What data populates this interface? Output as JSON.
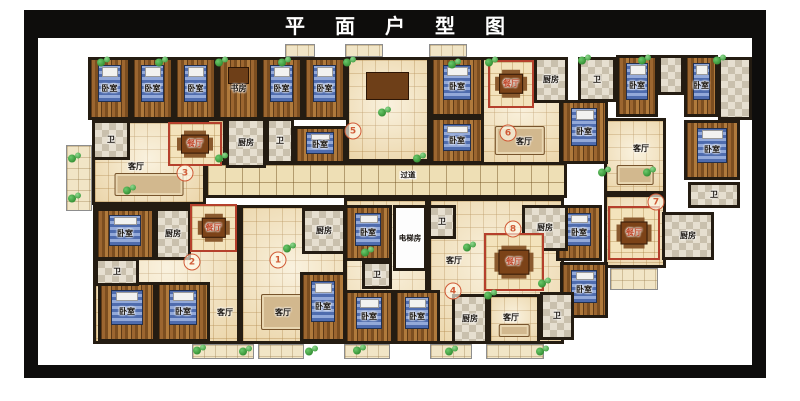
{
  "title": "平面户型图",
  "colors": {
    "frame": "#0e0d0c",
    "wall": "#241c12",
    "wood_floor": "#9c6630",
    "tile_floor": "#f5e7c4",
    "dining_border": "#b5402c",
    "unit_number": "#d05a36",
    "plant_green": "#2f8f2f"
  },
  "room_label_legend": {
    "bedroom": "卧室",
    "study": "书房",
    "living_room": "客厅",
    "dining_room": "餐厅",
    "kitchen": "厨房",
    "bathroom": "卫",
    "corridor": "过道",
    "elevator_room": "电梯房"
  },
  "plan": {
    "units": [
      {
        "n": "1",
        "x": 278,
        "y": 260
      },
      {
        "n": "2",
        "x": 192,
        "y": 262
      },
      {
        "n": "3",
        "x": 185,
        "y": 173
      },
      {
        "n": "4",
        "x": 453,
        "y": 291
      },
      {
        "n": "5",
        "x": 353,
        "y": 131
      },
      {
        "n": "6",
        "x": 508,
        "y": 133
      },
      {
        "n": "7",
        "x": 656,
        "y": 202
      },
      {
        "n": "8",
        "x": 513,
        "y": 229
      }
    ],
    "rooms": [
      {
        "n": "balcony",
        "x": 66,
        "y": 145,
        "w": 26,
        "h": 66,
        "f": "balc"
      },
      {
        "n": "balcony",
        "x": 285,
        "y": 44,
        "w": 30,
        "h": 13,
        "f": "balc"
      },
      {
        "n": "balcony",
        "x": 345,
        "y": 44,
        "w": 38,
        "h": 13,
        "f": "balc"
      },
      {
        "n": "balcony",
        "x": 429,
        "y": 44,
        "w": 38,
        "h": 13,
        "f": "balc"
      },
      {
        "n": "balcony",
        "x": 192,
        "y": 344,
        "w": 62,
        "h": 15,
        "f": "balc"
      },
      {
        "n": "balcony",
        "x": 258,
        "y": 344,
        "w": 46,
        "h": 15,
        "f": "balc"
      },
      {
        "n": "balcony",
        "x": 344,
        "y": 344,
        "w": 46,
        "h": 15,
        "f": "balc"
      },
      {
        "n": "balcony",
        "x": 430,
        "y": 344,
        "w": 42,
        "h": 15,
        "f": "balc"
      },
      {
        "n": "balcony",
        "x": 486,
        "y": 344,
        "w": 58,
        "h": 15,
        "f": "balc"
      },
      {
        "n": "balcony",
        "x": 610,
        "y": 268,
        "w": 48,
        "h": 22,
        "f": "balc"
      },
      {
        "n": "living-room-unit3",
        "l": "客厅",
        "x": 92,
        "y": 120,
        "w": 114,
        "h": 85,
        "f": "tile",
        "furn": "sofa",
        "lx": 133,
        "ly": 164
      },
      {
        "n": "hall-unit3",
        "x": 206,
        "y": 118,
        "w": 20,
        "h": 46,
        "f": "tile"
      },
      {
        "n": "hall-unit5",
        "x": 346,
        "y": 57,
        "w": 84,
        "h": 105,
        "f": "tile",
        "furn": "desk"
      },
      {
        "n": "living-room-unit6",
        "l": "客厅",
        "x": 478,
        "y": 57,
        "w": 84,
        "h": 109,
        "f": "tile",
        "furn": "sofa",
        "lx": 521,
        "ly": 139
      },
      {
        "n": "living-room-unit7",
        "l": "客厅",
        "x": 604,
        "y": 118,
        "w": 62,
        "h": 76,
        "f": "tile",
        "furn": "sofa",
        "lx": 638,
        "ly": 146
      },
      {
        "n": "dining-zone-unit7",
        "x": 604,
        "y": 194,
        "w": 62,
        "h": 74,
        "f": "tile"
      },
      {
        "n": "living-room-unit2",
        "l": "客厅",
        "x": 93,
        "y": 205,
        "w": 147,
        "h": 139,
        "f": "tile",
        "lx": 222,
        "ly": 310
      },
      {
        "n": "living-room-unit1",
        "l": "客厅",
        "x": 240,
        "y": 205,
        "w": 106,
        "h": 139,
        "f": "tile",
        "furn": "sofa",
        "lx": 280,
        "ly": 310
      },
      {
        "n": "hall-unit4",
        "x": 344,
        "y": 198,
        "w": 84,
        "h": 146,
        "f": "tile"
      },
      {
        "n": "living-room-unit8",
        "l": "客厅",
        "x": 428,
        "y": 198,
        "w": 136,
        "h": 146,
        "f": "tile",
        "lx": 451,
        "ly": 258
      },
      {
        "n": "living-room-unit4",
        "l": "客厅",
        "x": 488,
        "y": 294,
        "w": 52,
        "h": 50,
        "f": "tile",
        "furn": "sofa",
        "lx": 508,
        "ly": 315
      },
      {
        "n": "corridor",
        "l": "过道",
        "x": 205,
        "y": 162,
        "w": 362,
        "h": 36,
        "f": "corr",
        "lx": 405,
        "ly": 172
      },
      {
        "n": "bedroom",
        "l": "卧室",
        "x": 88,
        "y": 57,
        "w": 43,
        "h": 63,
        "f": "wood",
        "furn": "bed"
      },
      {
        "n": "bedroom",
        "l": "卧室",
        "x": 131,
        "y": 57,
        "w": 43,
        "h": 63,
        "f": "wood",
        "furn": "bed"
      },
      {
        "n": "bedroom",
        "l": "卧室",
        "x": 174,
        "y": 57,
        "w": 43,
        "h": 63,
        "f": "wood",
        "furn": "bed"
      },
      {
        "n": "study",
        "l": "书房",
        "x": 217,
        "y": 57,
        "w": 43,
        "h": 63,
        "f": "wood",
        "furn": "desk"
      },
      {
        "n": "bedroom",
        "l": "卧室",
        "x": 260,
        "y": 57,
        "w": 43,
        "h": 63,
        "f": "wood",
        "furn": "bed"
      },
      {
        "n": "bedroom",
        "l": "卧室",
        "x": 303,
        "y": 57,
        "w": 43,
        "h": 63,
        "f": "wood",
        "furn": "bed"
      },
      {
        "n": "bedroom",
        "l": "卧室",
        "x": 294,
        "y": 126,
        "w": 52,
        "h": 38,
        "f": "wood",
        "furn": "bed"
      },
      {
        "n": "bedroom",
        "l": "卧室",
        "x": 430,
        "y": 57,
        "w": 54,
        "h": 60,
        "f": "wood",
        "furn": "bed"
      },
      {
        "n": "bedroom",
        "l": "卧室",
        "x": 430,
        "y": 117,
        "w": 54,
        "h": 47,
        "f": "wood",
        "furn": "bed"
      },
      {
        "n": "bedroom",
        "l": "卧室",
        "x": 560,
        "y": 100,
        "w": 48,
        "h": 64,
        "f": "wood",
        "furn": "bed"
      },
      {
        "n": "bedroom",
        "l": "卧室",
        "x": 616,
        "y": 55,
        "w": 42,
        "h": 62,
        "f": "wood",
        "furn": "bed"
      },
      {
        "n": "bedroom",
        "l": "卧室",
        "x": 684,
        "y": 55,
        "w": 34,
        "h": 62,
        "f": "wood",
        "furn": "bed"
      },
      {
        "n": "bedroom",
        "l": "卧室",
        "x": 684,
        "y": 120,
        "w": 56,
        "h": 60,
        "f": "wood",
        "furn": "bed"
      },
      {
        "n": "bedroom",
        "l": "卧室",
        "x": 95,
        "y": 208,
        "w": 60,
        "h": 52,
        "f": "wood",
        "furn": "bed"
      },
      {
        "n": "bedroom",
        "l": "卧室",
        "x": 98,
        "y": 282,
        "w": 58,
        "h": 60,
        "f": "wood",
        "furn": "bed"
      },
      {
        "n": "bedroom",
        "l": "卧室",
        "x": 156,
        "y": 282,
        "w": 54,
        "h": 60,
        "f": "wood",
        "furn": "bed"
      },
      {
        "n": "bedroom",
        "l": "卧室",
        "x": 300,
        "y": 272,
        "w": 46,
        "h": 70,
        "f": "wood",
        "furn": "bed"
      },
      {
        "n": "bedroom",
        "l": "卧室",
        "x": 344,
        "y": 205,
        "w": 48,
        "h": 56,
        "f": "wood",
        "furn": "bed"
      },
      {
        "n": "bedroom",
        "l": "卧室",
        "x": 344,
        "y": 290,
        "w": 50,
        "h": 54,
        "f": "wood",
        "furn": "bed"
      },
      {
        "n": "bedroom",
        "l": "卧室",
        "x": 394,
        "y": 290,
        "w": 46,
        "h": 54,
        "f": "wood",
        "furn": "bed"
      },
      {
        "n": "bedroom",
        "l": "卧室",
        "x": 556,
        "y": 205,
        "w": 46,
        "h": 56,
        "f": "wood",
        "furn": "bed"
      },
      {
        "n": "bedroom",
        "l": "卧室",
        "x": 560,
        "y": 262,
        "w": 48,
        "h": 56,
        "f": "wood",
        "furn": "bed"
      },
      {
        "n": "bathroom",
        "l": "卫",
        "x": 92,
        "y": 120,
        "w": 38,
        "h": 40,
        "f": "chk"
      },
      {
        "n": "kitchen",
        "l": "厨房",
        "x": 226,
        "y": 118,
        "w": 40,
        "h": 50,
        "f": "chk"
      },
      {
        "n": "bathroom",
        "l": "卫",
        "x": 266,
        "y": 118,
        "w": 28,
        "h": 46,
        "f": "chk"
      },
      {
        "n": "kitchen",
        "l": "厨房",
        "x": 534,
        "y": 57,
        "w": 34,
        "h": 46,
        "f": "chk"
      },
      {
        "n": "bathroom",
        "l": "卫",
        "x": 578,
        "y": 57,
        "w": 38,
        "h": 45,
        "f": "chk"
      },
      {
        "n": "closet",
        "x": 658,
        "y": 55,
        "w": 26,
        "h": 40,
        "f": "chk"
      },
      {
        "n": "bathroom",
        "x": 718,
        "y": 57,
        "w": 34,
        "h": 63,
        "f": "chk"
      },
      {
        "n": "bathroom",
        "l": "卫",
        "x": 688,
        "y": 182,
        "w": 52,
        "h": 26,
        "f": "chk"
      },
      {
        "n": "kitchen",
        "l": "厨房",
        "x": 662,
        "y": 212,
        "w": 52,
        "h": 48,
        "f": "chk"
      },
      {
        "n": "kitchen",
        "l": "厨房",
        "x": 155,
        "y": 208,
        "w": 36,
        "h": 52,
        "f": "chk"
      },
      {
        "n": "bathroom",
        "l": "卫",
        "x": 95,
        "y": 258,
        "w": 44,
        "h": 28,
        "f": "chk"
      },
      {
        "n": "kitchen",
        "l": "厨房",
        "x": 302,
        "y": 208,
        "w": 44,
        "h": 46,
        "f": "chk"
      },
      {
        "n": "bathroom",
        "l": "卫",
        "x": 362,
        "y": 261,
        "w": 30,
        "h": 28,
        "f": "chk"
      },
      {
        "n": "bathroom",
        "l": "卫",
        "x": 428,
        "y": 205,
        "w": 28,
        "h": 34,
        "f": "chk"
      },
      {
        "n": "kitchen",
        "l": "厨房",
        "x": 522,
        "y": 205,
        "w": 46,
        "h": 46,
        "f": "chk"
      },
      {
        "n": "kitchen",
        "l": "厨房",
        "x": 452,
        "y": 294,
        "w": 36,
        "h": 50,
        "f": "chk"
      },
      {
        "n": "bathroom",
        "l": "卫",
        "x": 540,
        "y": 292,
        "w": 34,
        "h": 48,
        "f": "chk"
      },
      {
        "n": "dining-room",
        "l": "餐厅",
        "x": 168,
        "y": 122,
        "w": 54,
        "h": 44,
        "f": "dine",
        "furn": "table"
      },
      {
        "n": "dining-room",
        "l": "餐厅",
        "x": 190,
        "y": 204,
        "w": 47,
        "h": 48,
        "f": "dine",
        "furn": "table"
      },
      {
        "n": "dining-room",
        "l": "餐厅",
        "x": 488,
        "y": 60,
        "w": 46,
        "h": 48,
        "f": "dine",
        "furn": "table"
      },
      {
        "n": "dining-room",
        "l": "餐厅",
        "x": 608,
        "y": 206,
        "w": 52,
        "h": 54,
        "f": "dine",
        "furn": "table"
      },
      {
        "n": "dining-room",
        "l": "餐厅",
        "x": 484,
        "y": 233,
        "w": 60,
        "h": 58,
        "f": "dine",
        "furn": "table"
      },
      {
        "n": "elevator-room",
        "l": "电梯房",
        "x": 393,
        "y": 205,
        "w": 34,
        "h": 66,
        "f": "elev"
      }
    ],
    "plants": [
      [
        75,
        158
      ],
      [
        75,
        198
      ],
      [
        104,
        62
      ],
      [
        162,
        62
      ],
      [
        222,
        62
      ],
      [
        285,
        62
      ],
      [
        350,
        62
      ],
      [
        385,
        112
      ],
      [
        455,
        64
      ],
      [
        492,
        62
      ],
      [
        585,
        60
      ],
      [
        645,
        60
      ],
      [
        720,
        60
      ],
      [
        130,
        190
      ],
      [
        222,
        158
      ],
      [
        420,
        158
      ],
      [
        290,
        248
      ],
      [
        470,
        247
      ],
      [
        491,
        295
      ],
      [
        545,
        283
      ],
      [
        605,
        172
      ],
      [
        650,
        172
      ],
      [
        368,
        252
      ],
      [
        200,
        350
      ],
      [
        246,
        351
      ],
      [
        312,
        351
      ],
      [
        360,
        350
      ],
      [
        452,
        351
      ],
      [
        543,
        351
      ]
    ]
  }
}
